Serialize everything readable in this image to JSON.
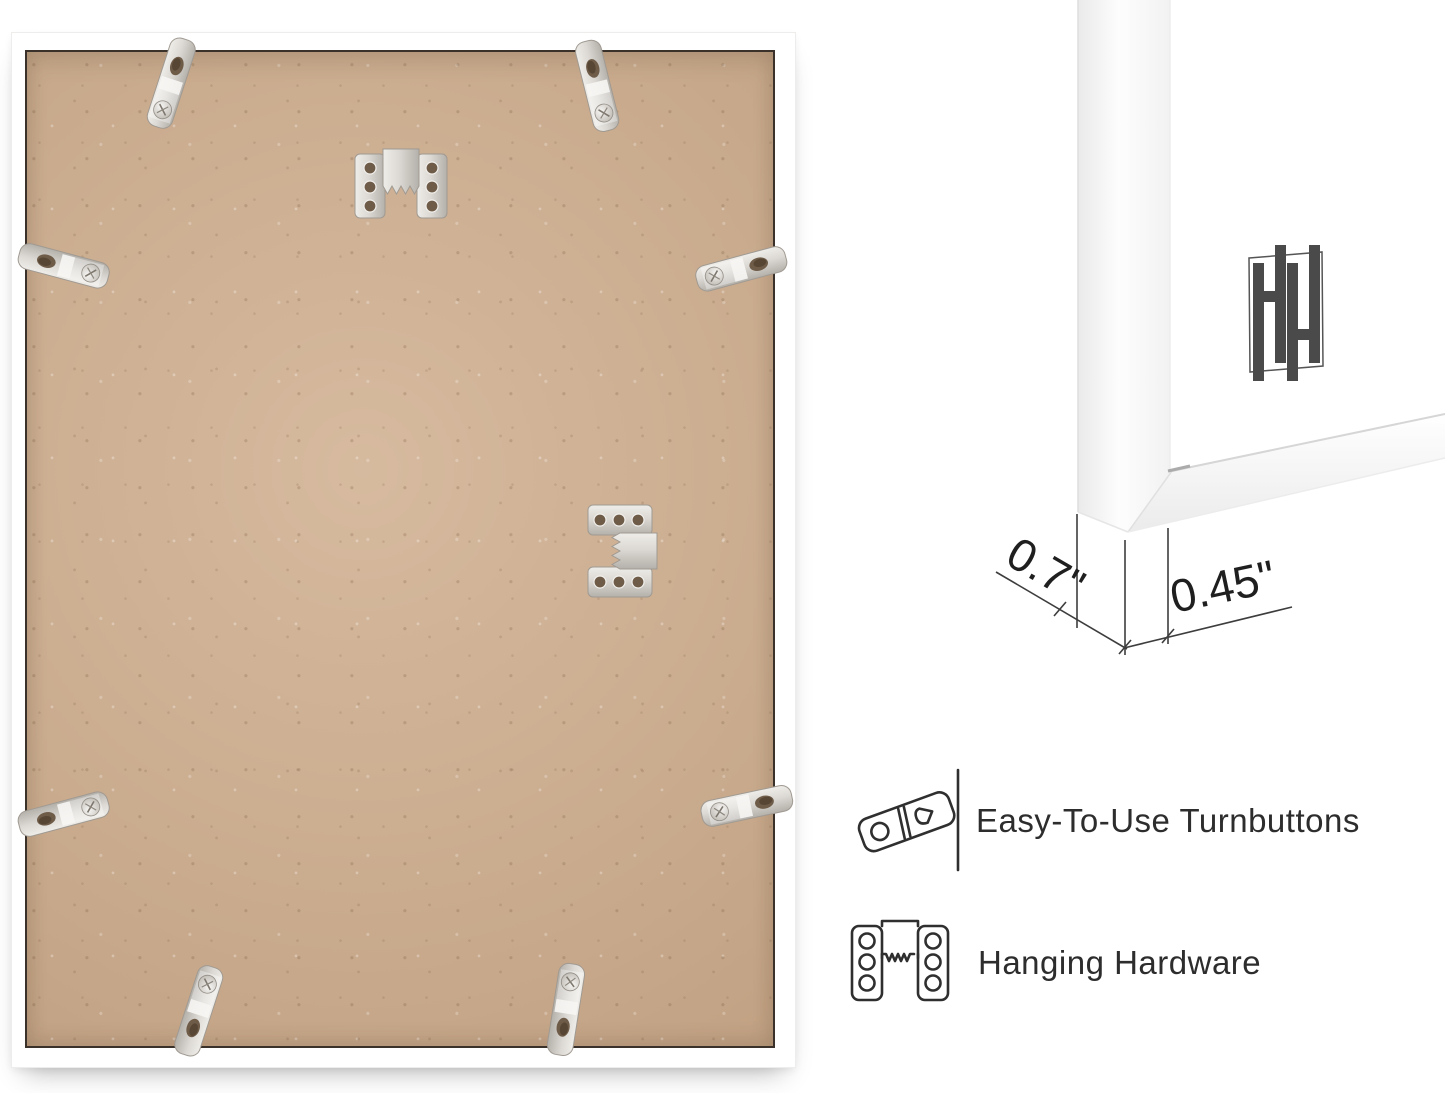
{
  "product_view": {
    "main_image": "back-of-white-picture-frame-with-mdf-board",
    "hardware": {
      "turnbutton_count": 8,
      "sawtooth_hanger_count": 2
    }
  },
  "closeup": {
    "brand_monogram": "HH",
    "dimensions": {
      "depth": "0.7\"",
      "face_width": "0.45\""
    }
  },
  "features": [
    {
      "icon": "turnbutton-icon",
      "label": "Easy-To-Use Turnbuttons"
    },
    {
      "icon": "hanging-hardware-icon",
      "label": "Hanging Hardware"
    }
  ],
  "colors": {
    "board_tan": "#cbaa8b",
    "frame_white": "#ffffff",
    "metal_silver": "#d9d6d1",
    "dimension_line": "#3d3d3d",
    "feature_text": "#2d2d2d",
    "logo_gray": "#4a4a4a"
  }
}
